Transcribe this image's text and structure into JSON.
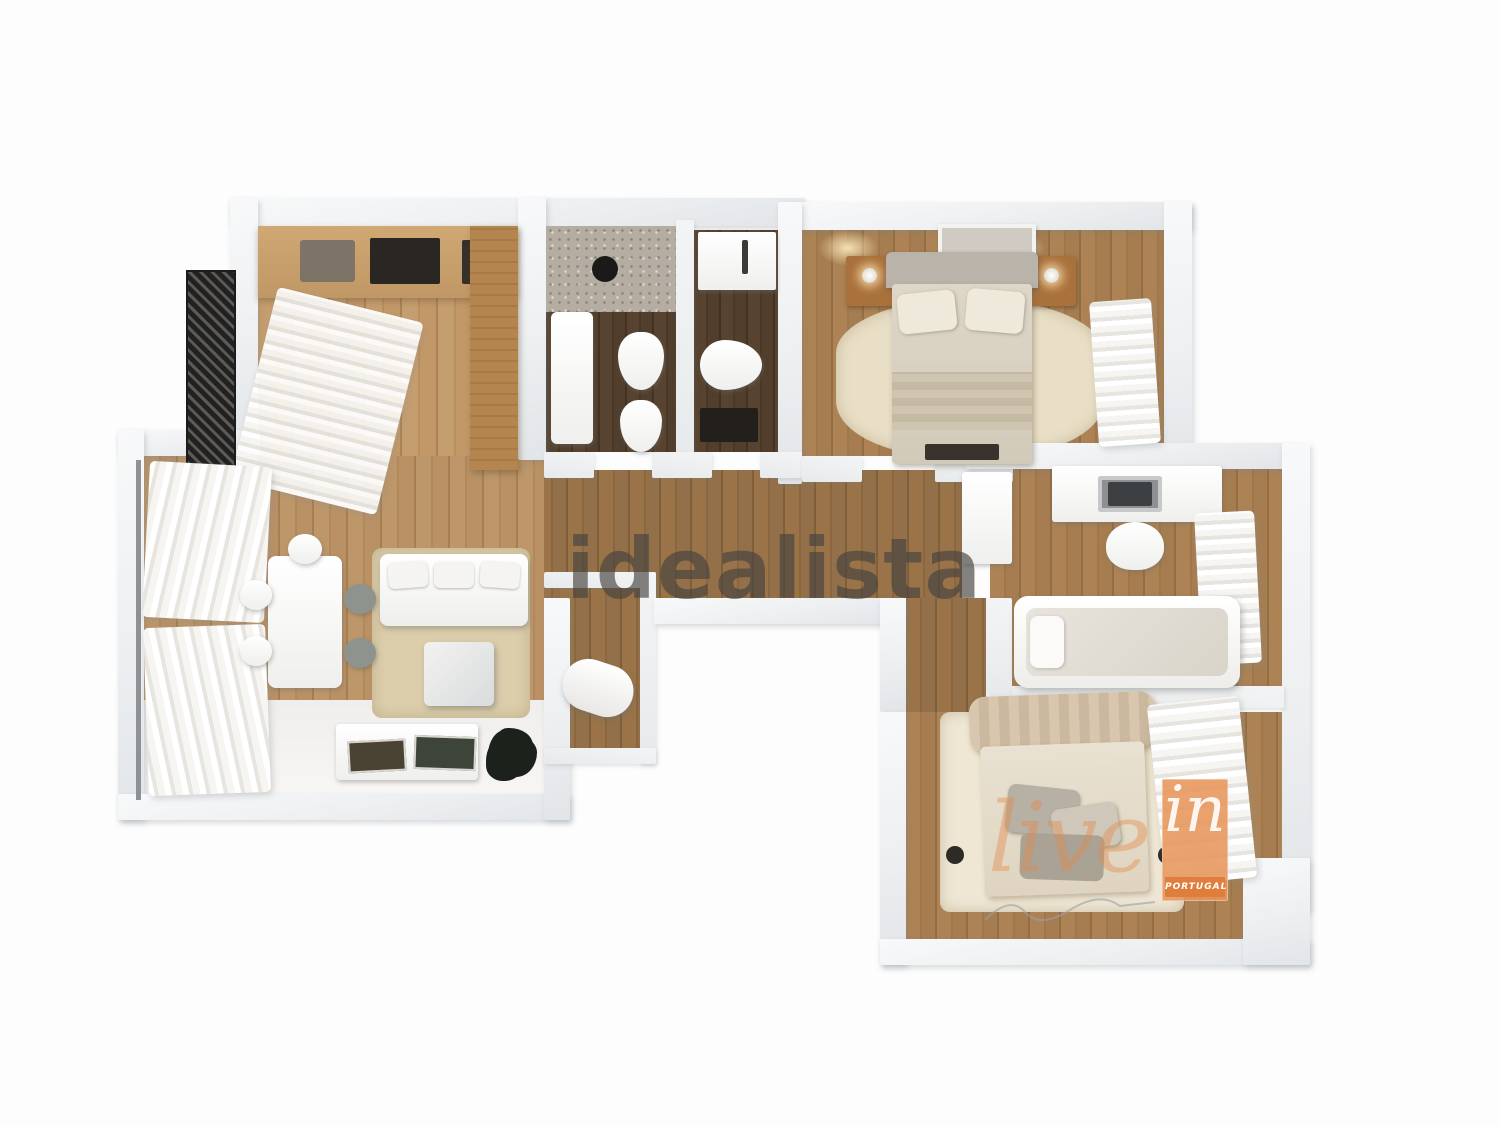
{
  "watermarks": {
    "center": "idealista",
    "live": "live",
    "in": "in",
    "portugal": "PORTUGAL"
  },
  "colors": {
    "watermark_gray": "#464340",
    "brand_orange": "#e7955b",
    "wall": "#eef0f2",
    "wood_light": "#c59e6f",
    "wood_hall": "#9a7448",
    "wood_bath_dark": "#4e3b29",
    "rug_beige": "#e9dfc6"
  }
}
